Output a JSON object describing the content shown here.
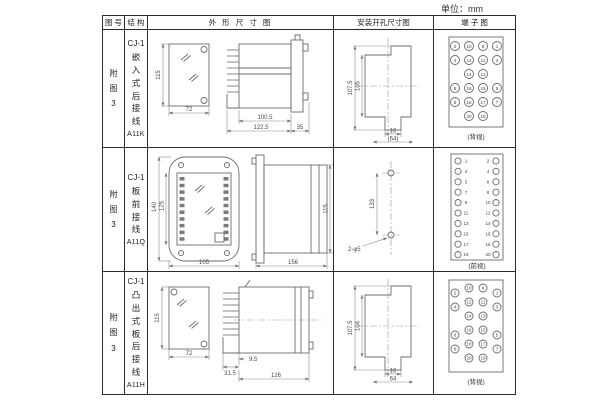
{
  "unit_label": "单位：mm",
  "headers": {
    "fig": "图 号",
    "structure": "结 构",
    "outline": "外 形 尺 寸 图",
    "mounting": "安装开孔尺寸图",
    "terminal": "端 子 图"
  },
  "rows": [
    {
      "fig_no": "附图3",
      "structure": {
        "model": "CJ-1",
        "desc": "嵌入式后接线",
        "code": "A11K"
      },
      "outline": {
        "front_height": "115",
        "front_width": "72",
        "case_depth": "100.5",
        "total_depth": "122.5",
        "flange_depth": "35"
      },
      "mounting": {
        "outer_height": "107.5",
        "cutout_height": "105",
        "slot_width": "16",
        "hole_span": "(64)"
      },
      "terminal": {
        "view": "(背视)",
        "grid": [
          [
            "2",
            "10",
            "9",
            "1"
          ],
          [
            "4",
            "12",
            "11",
            "3"
          ],
          [
            "14",
            "13"
          ],
          [
            "6",
            "16",
            "15",
            "5"
          ],
          [
            "8",
            "18",
            "17",
            "7"
          ],
          [
            "20",
            "19"
          ]
        ]
      }
    },
    {
      "fig_no": "附图3",
      "structure": {
        "model": "CJ-1",
        "desc": "板前接线",
        "code": "A11Q"
      },
      "outline": {
        "plate_height": "140",
        "terminal_height": "125",
        "plate_width": "105",
        "case_depth": "156",
        "case_height": "115"
      },
      "mounting": {
        "hole_spacing": "133",
        "holes": "2-φ5"
      },
      "terminal": {
        "view": "(前视)",
        "pairs": [
          [
            "1",
            "2"
          ],
          [
            "3",
            "4"
          ],
          [
            "5",
            "6"
          ],
          [
            "7",
            "8"
          ],
          [
            "9",
            "10"
          ],
          [
            "11",
            "12"
          ],
          [
            "13",
            "14"
          ],
          [
            "15",
            "16"
          ],
          [
            "17",
            "18"
          ],
          [
            "19",
            "20"
          ]
        ]
      }
    },
    {
      "fig_no": "附图3",
      "structure": {
        "model": "CJ-1",
        "desc": "凸出式板后接线",
        "code": "A11H"
      },
      "outline": {
        "front_height": "115",
        "front_width": "72",
        "pin_depth": "31.5",
        "step_depth": "9.5",
        "case_depth": "126"
      },
      "mounting": {
        "outer_height": "107.5",
        "cutout_height": "104",
        "slot_width": "16",
        "hole_span": "64"
      },
      "terminal": {
        "view": "(背视)",
        "grid": [
          [
            "2",
            "10",
            "9",
            "1"
          ],
          [
            "4",
            "12",
            "11",
            "3"
          ],
          [
            "14",
            "13"
          ],
          [
            "6",
            "16",
            "15",
            "5"
          ],
          [
            "8",
            "18",
            "17",
            "7"
          ],
          [
            "20",
            "19"
          ]
        ]
      }
    }
  ]
}
